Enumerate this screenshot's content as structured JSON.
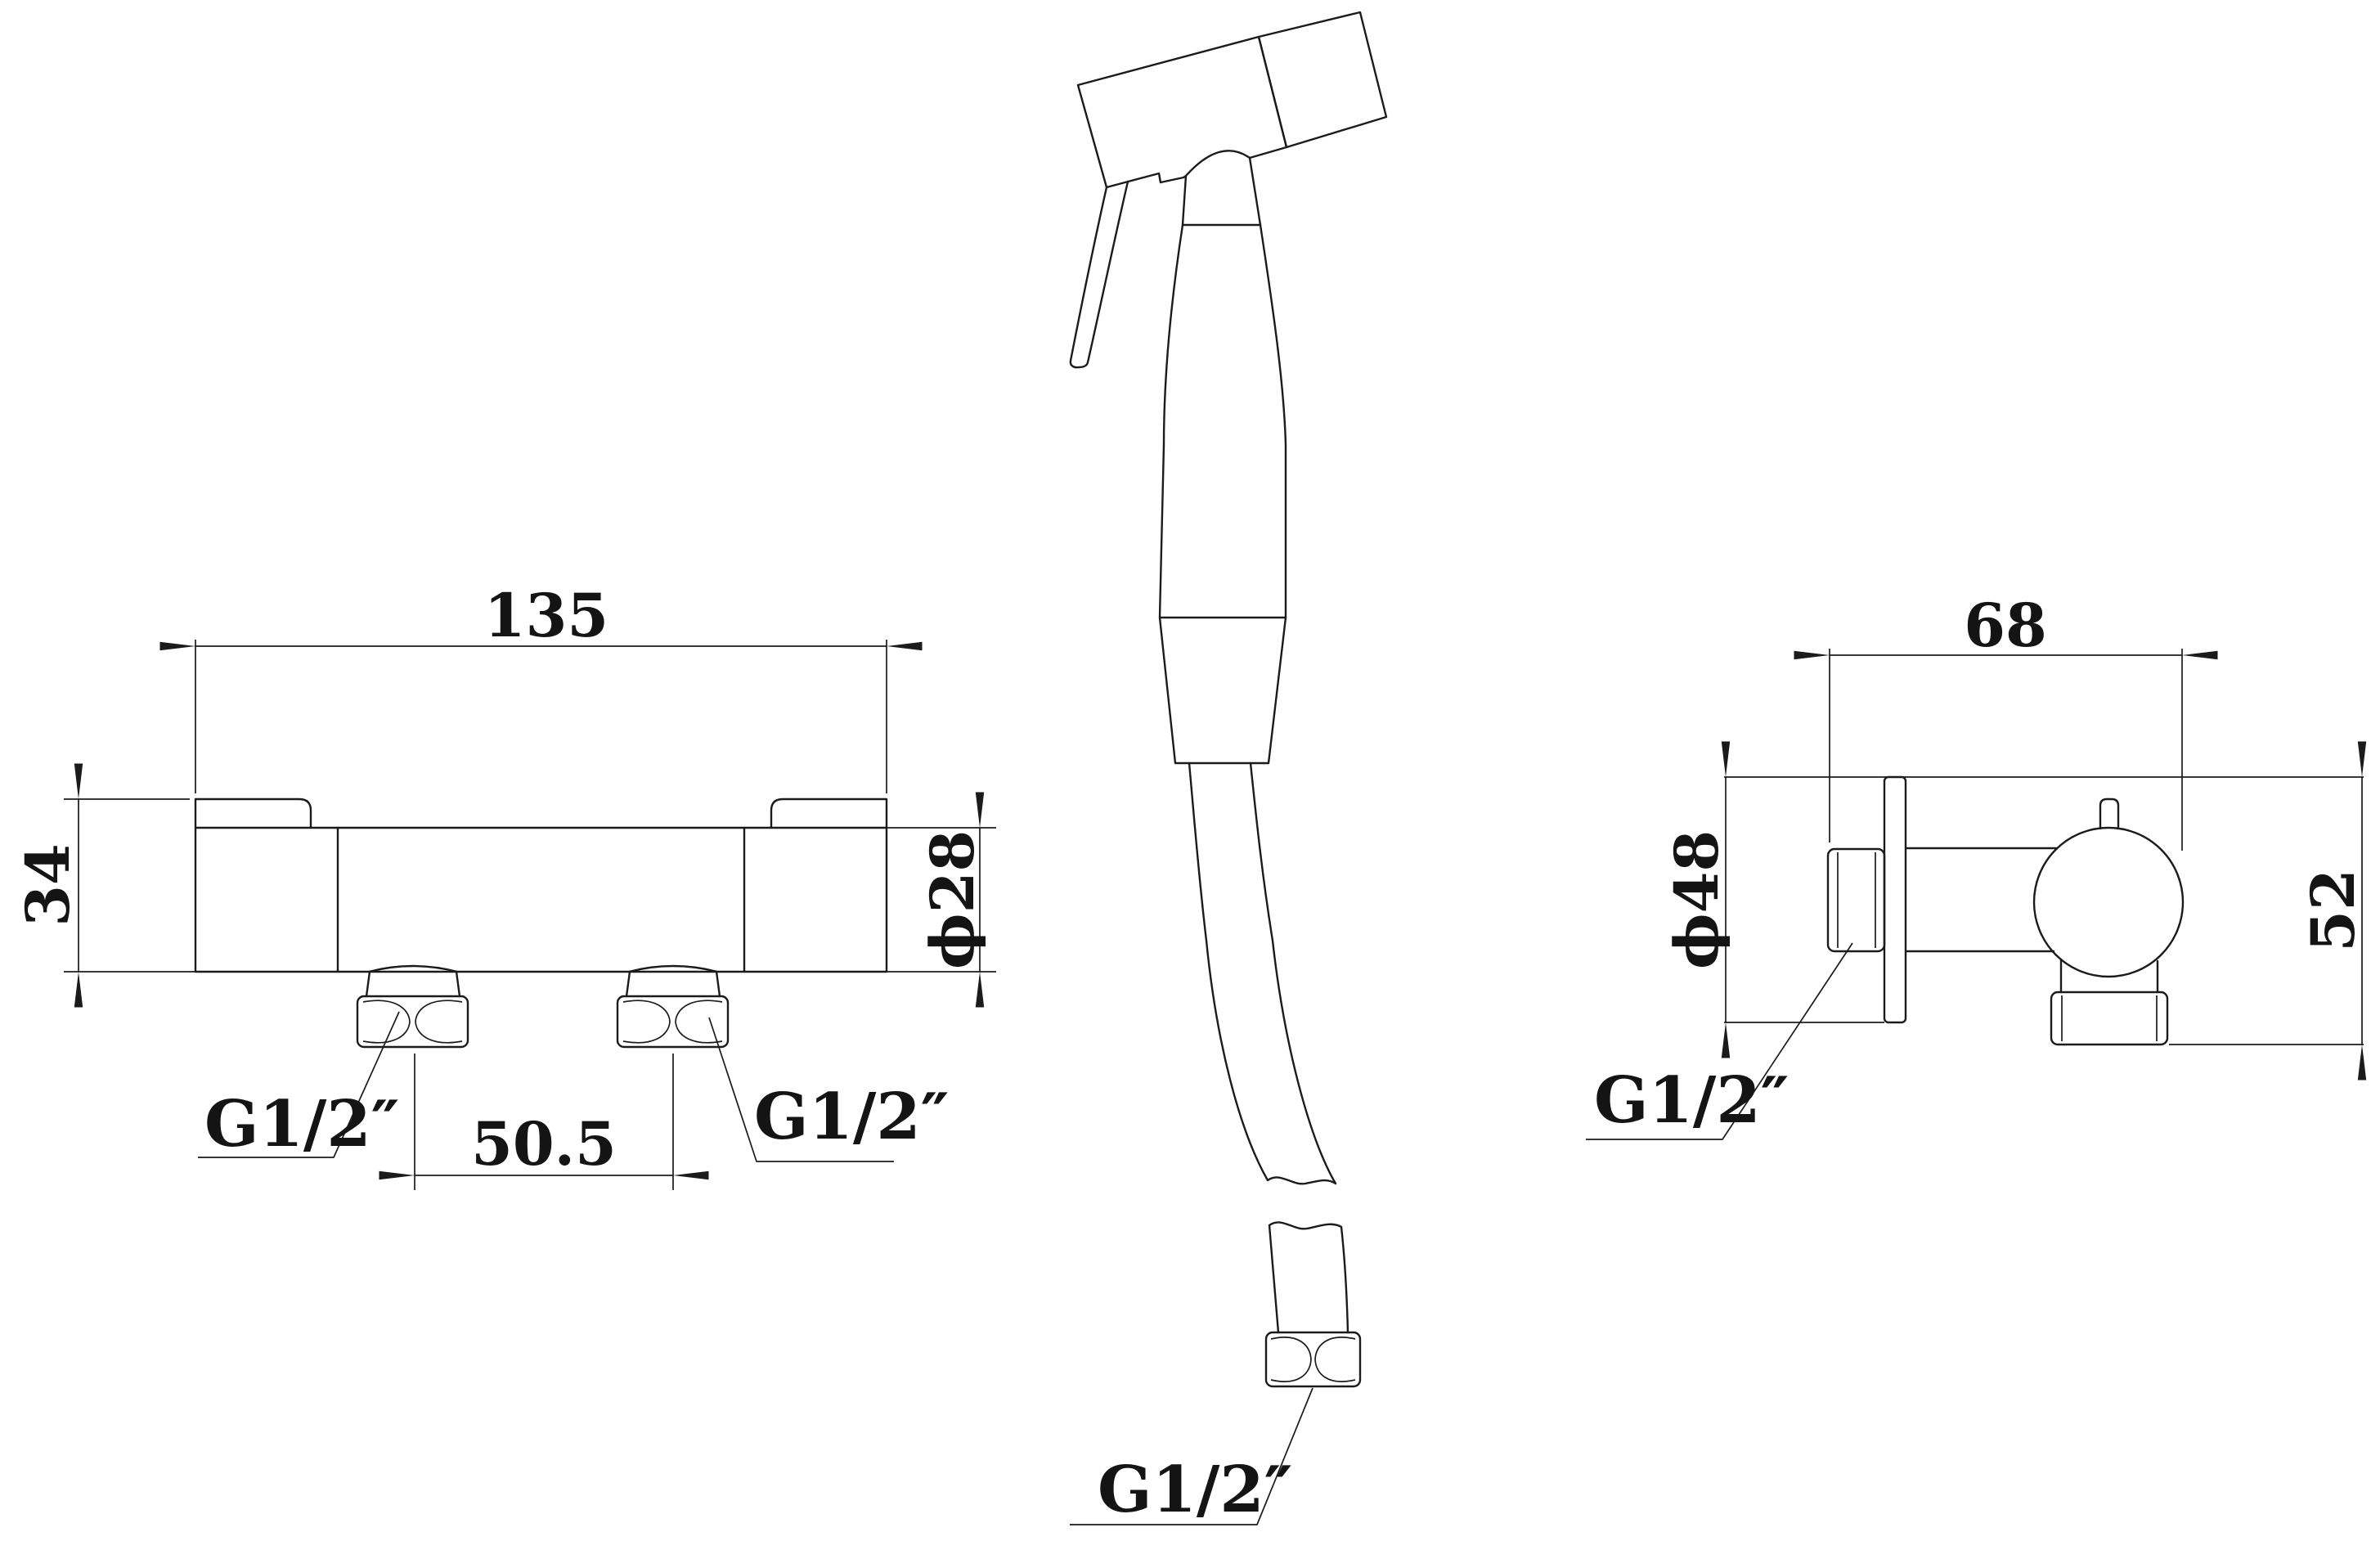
{
  "colors": {
    "background": "#ffffff",
    "line": "#1b1b1b",
    "text": "#141414"
  },
  "front_view": {
    "width": "135",
    "height": "34",
    "body_diameter": "ϕ28",
    "outlet_spacing": "50.5",
    "thread_left": "G1/2″",
    "thread_right": "G1/2″"
  },
  "handset_view": {
    "hose_thread": "G1/2″"
  },
  "side_view": {
    "depth": "68",
    "flange_diameter": "ϕ48",
    "height": "52",
    "thread": "G1/2″"
  }
}
